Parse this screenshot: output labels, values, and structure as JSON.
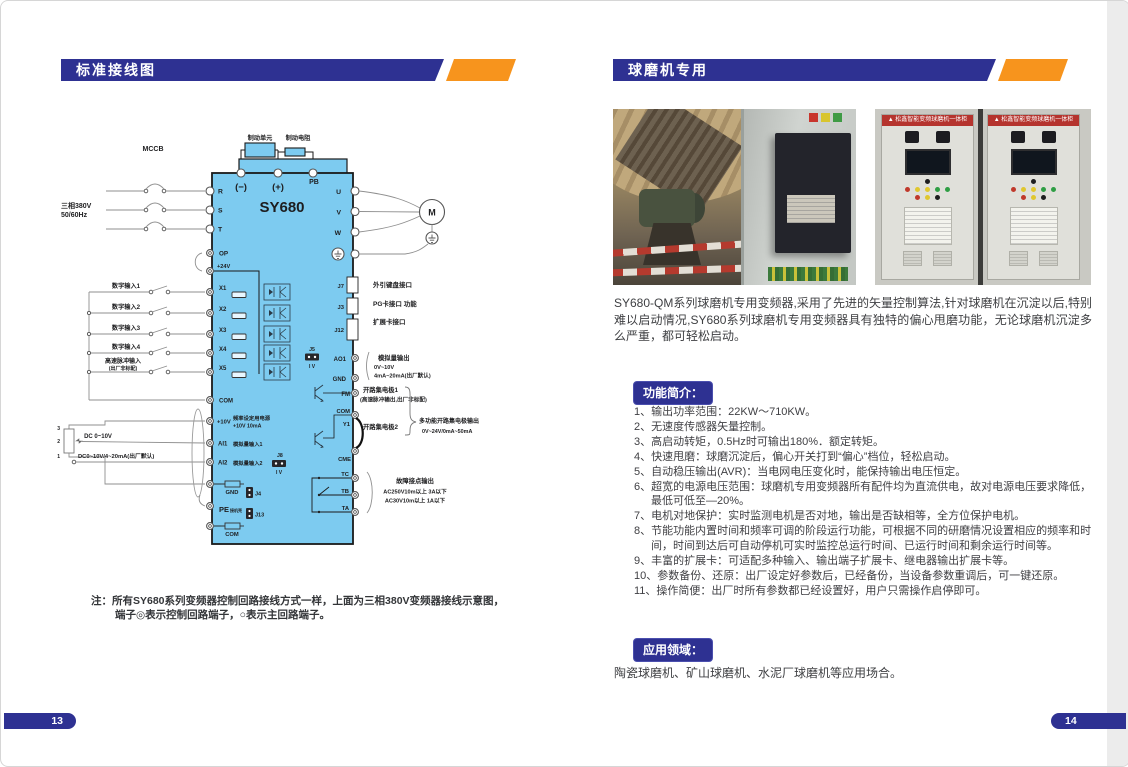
{
  "colors": {
    "header_blue": "#2e3192",
    "accent_orange": "#f7941d",
    "diagram_fill": "#7dcbf0"
  },
  "left_page": {
    "header": "标准接线图",
    "page_number": "13",
    "note1": "注：所有SY680系列变频器控制回路接线方式一样，上面为三相380V变频器接线示意图，",
    "note2": "端子◎表示控制回路端子，○表示主回路端子。",
    "diagram": {
      "model": "SY680",
      "mccb": "MCCB",
      "supply1": "三相380V",
      "supply2": "50/60Hz",
      "brake_unit": "制动单元",
      "brake_res": "制动电阻",
      "neg": "(−)",
      "pos": "(+)",
      "pb": "PB",
      "r": "R",
      "s": "S",
      "t": "T",
      "op": "OP",
      "v24": "+24V",
      "x1": "X1",
      "x2": "X2",
      "x3": "X3",
      "x4": "X4",
      "x5": "X5",
      "di1": "数字输入1",
      "di2": "数字输入2",
      "di3": "数字输入3",
      "di4": "数字输入4",
      "hp1": "高速脉冲输入",
      "hp2": "(出厂非标配)",
      "com1": "COM",
      "com2": "COM",
      "com3": "COM",
      "v10": "+10V",
      "fps1": "频率设定用电源",
      "fps2": "+10V 10mA",
      "ai1": "AI1",
      "ai1l": "模拟量输入1",
      "ai2": "AI2",
      "ai2l": "模拟量输入2",
      "pot3": "3",
      "pot2": "2",
      "pot1": "1",
      "dc1": "DC 0~10V",
      "dc2": "DC0~10V/4~20mA(出厂默认)",
      "gnd1": "GND",
      "gnd2": "GND",
      "j4": "J4",
      "j13": "J13",
      "j8": "J8",
      "j5": "J5",
      "iv": "I V",
      "pe": "PE",
      "pe2": "接机壳",
      "u": "U",
      "v": "V",
      "w": "W",
      "m": "M",
      "j7": "J7",
      "j7l": "外引键盘接口",
      "j3": "J3",
      "j3l": "PG卡接口 功能",
      "j12": "J12",
      "j12l": "扩展卡接口",
      "ao1": "AO1",
      "aol1": "模拟量输出",
      "aol2": "0V~10V",
      "aol3": "4mA~20mA(出厂默认)",
      "fm": "FM",
      "oc1": "开路集电极1",
      "oc1b": "(高速脉冲输出,出厂非标配)",
      "y1": "Y1",
      "oc2": "开路集电极2",
      "cme": "CME",
      "mf1": "多功能开路集电极输出",
      "mf2": "0V~24V/0mA~50mA",
      "tc": "TC",
      "tb": "TB",
      "ta": "TA",
      "flt1": "故障接点输出",
      "flt2": "AC250V10m以上 3A以下",
      "flt3": "AC30V10m以上 1A以下"
    }
  },
  "right_page": {
    "header": "球磨机专用",
    "page_number": "14",
    "photos": {
      "cabinet_title": "松鑫智能变频球磨机一体柜"
    },
    "intro": "SY680-QM系列球磨机专用变频器,采用了先进的矢量控制算法,针对球磨机在沉淀以后,特别难以启动情况,SY680系列球磨机专用变频器具有独特的偏心甩磨功能，无论球磨机沉淀多么严重，都可轻松启动。",
    "features_title": "功能简介：",
    "features": [
      "1、输出功率范围：22KW～710KW。",
      "2、无速度传感器矢量控制。",
      "3、高启动转矩，0.5Hz时可输出180%．额定转矩。",
      "4、快速甩磨：球磨沉淀后，偏心开关打到“偏心”档位，轻松启动。",
      "5、自动稳压输出(AVR)：当电网电压变化时，能保持输出电压恒定。",
      "6、超宽的电源电压范围：球磨机专用变频器所有配件均为直流供电，故对电源电压要求降低，最低可低至—20%。",
      "7、电机对地保护：实时监测电机是否对地，输出是否缺相等，全方位保护电机。",
      "8、节能功能内置时间和频率可调的阶段运行功能，可根据不同的研磨情况设置相应的频率和时间，时间到达后可自动停机可实时监控总运行时间、已运行时间和剩余运行时间等。",
      "9、丰富的扩展卡：可适配多种输入、输出端子扩展卡、继电器输出扩展卡等。",
      "10、参数备份、还原：出厂设定好参数后，已经备份，当设备参数重调后，可一键还原。",
      "11、操作简便：出厂时所有参数都已经设置好，用户只需操作启停即可。"
    ],
    "fields_title": "应用领域：",
    "fields_text": "陶瓷球磨机、矿山球磨机、水泥厂球磨机等应用场合。"
  }
}
